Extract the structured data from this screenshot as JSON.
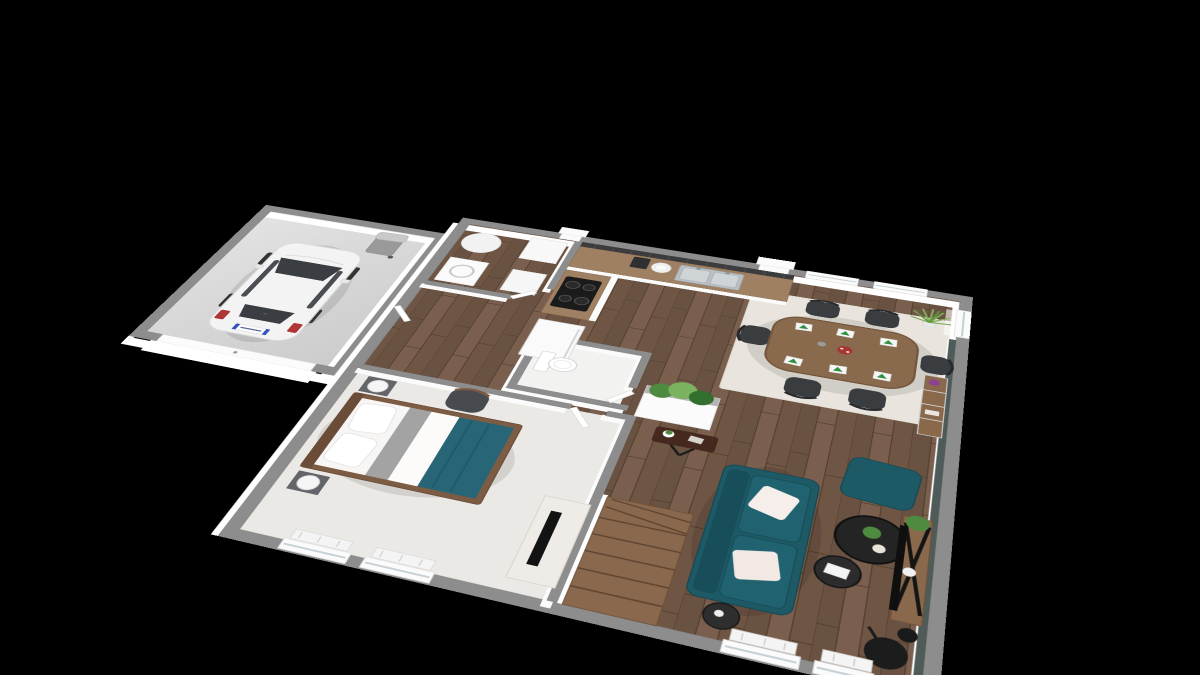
{
  "scene": {
    "description": "3D isometric architectural render of a single-storey house floor plan floating on a black background",
    "background": "#000000",
    "view": "tilted top-down 3D dollhouse view, rotated clockwise",
    "colors": {
      "wall_top": "#8d8d8d",
      "wall_face": "#ffffff",
      "accent_wall": "#4e5b58",
      "floor_wood": "#715848",
      "floor_wood_dark": "#5a4436",
      "garage_floor": "#d6d6d6",
      "carpet": "#ebe9e5",
      "wc_floor": "#f2f2f0",
      "rug": "#e9e5de",
      "sofa_teal": "#1d5a66",
      "sofa_teal_dark": "#174e59",
      "bed_blanket_teal": "#276577",
      "table_wood": "#8a6a4c",
      "chair_dark": "#3a3d40",
      "counter_wood": "#a08063",
      "backsplash": "#3c3b3d",
      "cooktop": "#1b1b1b",
      "plant_green": "#4e8a3f",
      "plant_green_light": "#7ab25f",
      "napkin_green": "#2f9140",
      "decor_black": "#242424",
      "car_body": "#f3f3f3",
      "car_glass": "#3a3e42",
      "taillight_red": "#b03636",
      "plate_blue": "#3355bb",
      "bin_gray": "#9a9a9b",
      "flower_red": "#a83434",
      "flower_purple": "#8e4390"
    },
    "rooms": [
      {
        "name": "garage",
        "floor": "concrete",
        "items": [
          "white-hatchback-car",
          "wheeled-trash-bin",
          "garage-door"
        ]
      },
      {
        "name": "utility-room",
        "floor": "wood",
        "items": [
          "washing-machine",
          "cylindrical-water-heater",
          "storage-cabinets"
        ]
      },
      {
        "name": "kitchen",
        "floor": "wood",
        "items": [
          "l-shaped-counter",
          "induction-cooktop",
          "double-stainless-sink",
          "coffee-machine",
          "plate-stack",
          "fridge",
          "dark-tile-backsplash"
        ]
      },
      {
        "name": "wc",
        "floor": "tile",
        "items": [
          "toilet"
        ]
      },
      {
        "name": "hallway",
        "floor": "wood",
        "items": [
          "white-interior-doors",
          "entry-porch"
        ]
      },
      {
        "name": "bedroom",
        "floor": "carpet",
        "items": [
          "double-bed-with-teal-throw",
          "two-nightstands-with-lamps",
          "armchair",
          "tv-dresser",
          "windows-with-radiators"
        ]
      },
      {
        "name": "staircase",
        "floor": "wood",
        "items": [
          "winder-staircase"
        ]
      },
      {
        "name": "living-dining-room",
        "floor": "wood",
        "items": [
          "oval-dining-table",
          "six-black-chairs",
          "six-place-settings",
          "red-flower-centerpiece",
          "cream-area-rug",
          "teal-sofa-with-white-cushions",
          "teal-ottoman",
          "two-round-black-coffee-tables",
          "tv-console-with-x-stand",
          "floor-lamp",
          "side-table",
          "metal-wood-shelf-unit",
          "planter-half-wall",
          "small-desk",
          "tall-grass-plant",
          "sheer-curtains",
          "teal-accent-wall",
          "windows-with-radiators"
        ]
      }
    ],
    "car": {
      "type": "white-hatchback",
      "license_plate_style": "eu-blue-bands",
      "plate_text_visible": false
    }
  }
}
